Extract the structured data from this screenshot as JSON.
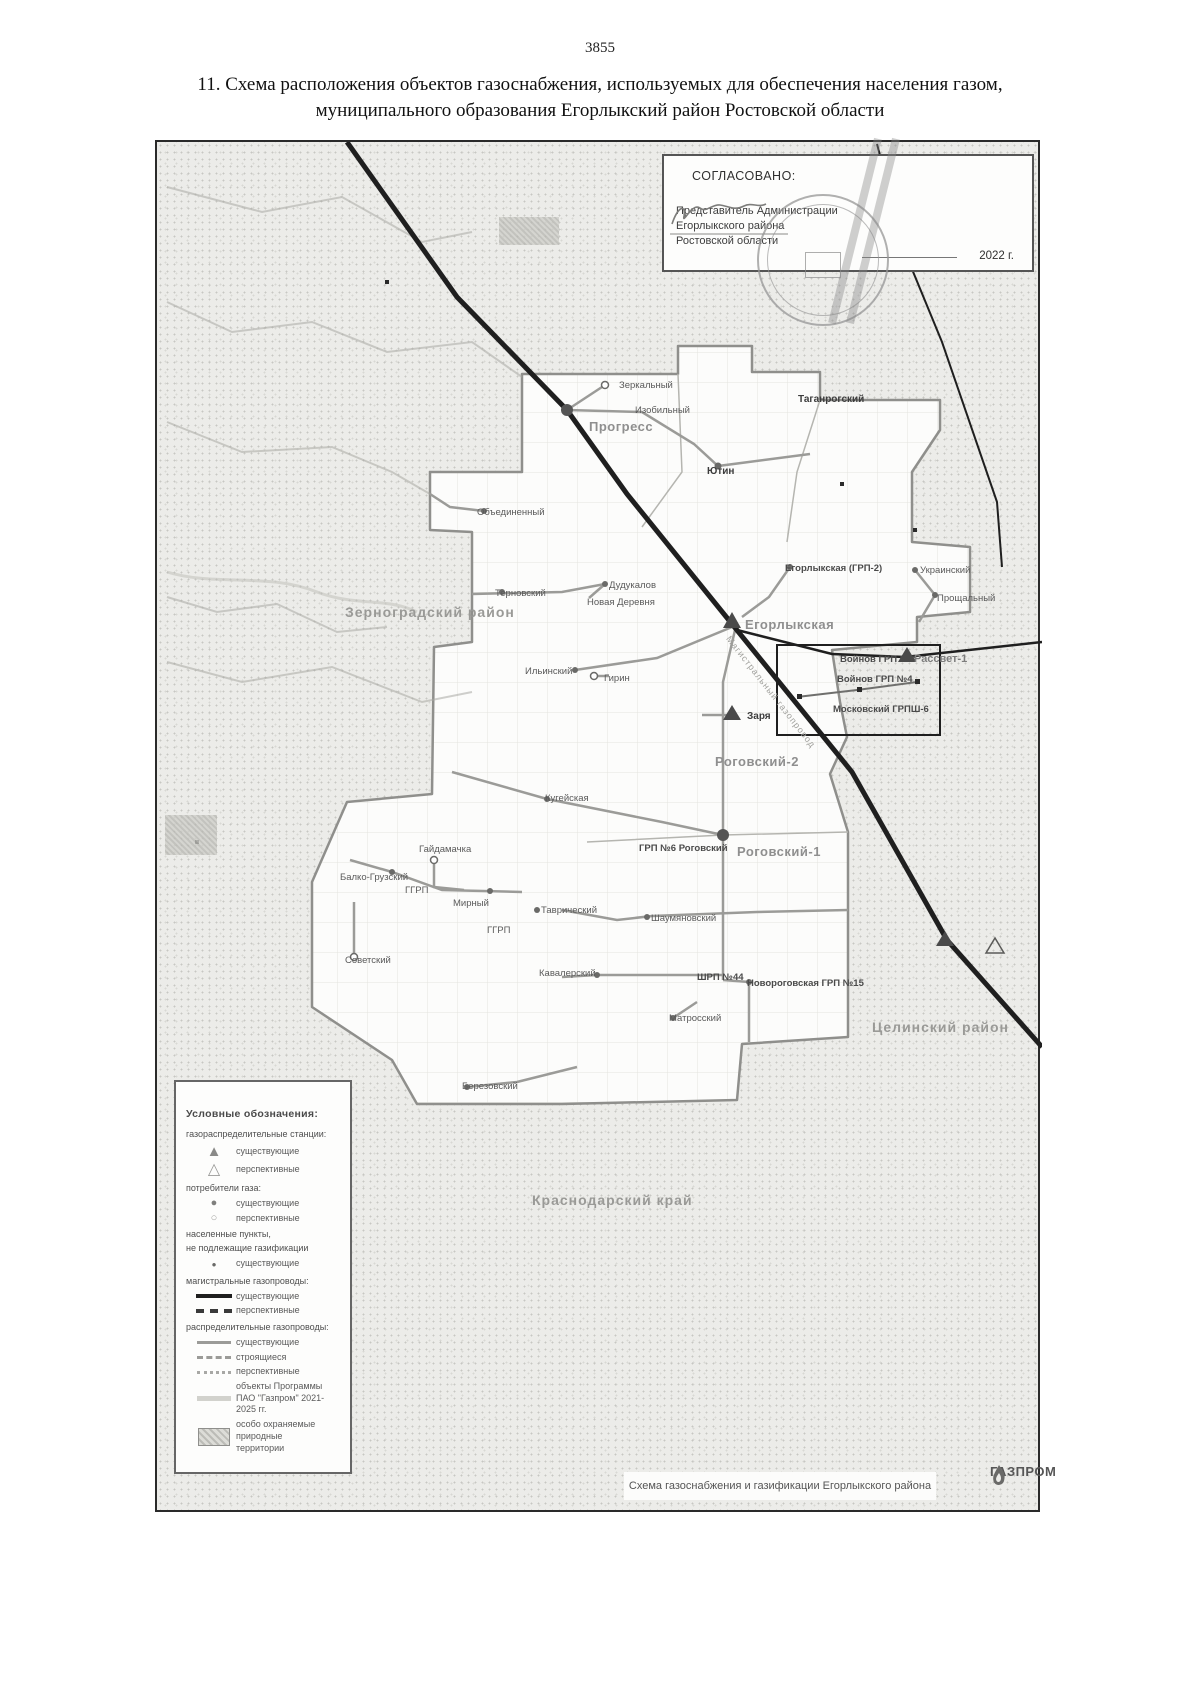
{
  "page": {
    "number": "3855",
    "title_line1": "11. Схема расположения объектов газоснабжения, используемых для обеспечения населения газом,",
    "title_line2": "муниципального образования Егорлыкский район Ростовской области"
  },
  "approval": {
    "heading": "СОГЛАСОВАНО:",
    "lines": [
      "Представитель Администрации",
      "Егорлыкского района",
      "Ростовской области"
    ],
    "year": "2022 г.",
    "stamp": "round-seal",
    "signature": "handwritten-signature"
  },
  "map": {
    "caption": "Схема газоснабжения и газификации Егорлыкского района",
    "brand": "ГАЗПРОМ",
    "pipeline_label": "Магистральный газопровод",
    "colors": {
      "main_pipeline": "#1f1f1f",
      "distribution": "#9b9b98",
      "boundary": "#8f8f8c"
    },
    "labels": [
      {
        "text": "Зеркальный",
        "x": 462,
        "y": 239
      },
      {
        "text": "Изобильный",
        "x": 478,
        "y": 264
      },
      {
        "text": "Прогресс",
        "x": 432,
        "y": 278,
        "cls": "town"
      },
      {
        "text": "Таганрогский",
        "x": 641,
        "y": 253,
        "cls": "dark"
      },
      {
        "text": "Ютин",
        "x": 550,
        "y": 325,
        "cls": "dark"
      },
      {
        "text": "Объединенный",
        "x": 320,
        "y": 366
      },
      {
        "text": "Терновский",
        "x": 338,
        "y": 447
      },
      {
        "text": "Дудукалов",
        "x": 452,
        "y": 439
      },
      {
        "text": "Новая Деревня",
        "x": 430,
        "y": 456
      },
      {
        "text": "Егорлыкская (ГРП-2)",
        "x": 628,
        "y": 422,
        "cls": "grp"
      },
      {
        "text": "Украинский",
        "x": 763,
        "y": 424
      },
      {
        "text": "Прощальный",
        "x": 780,
        "y": 452
      },
      {
        "text": "Зерноградский район",
        "x": 188,
        "y": 463,
        "cls": "region"
      },
      {
        "text": "Егорлыкская",
        "x": 588,
        "y": 476,
        "cls": "town"
      },
      {
        "text": "Войнов ГРП №3",
        "x": 683,
        "y": 513,
        "cls": "grp"
      },
      {
        "text": "Войнов ГРП №4",
        "x": 680,
        "y": 533,
        "cls": "grp"
      },
      {
        "text": "Рассвет-1",
        "x": 757,
        "y": 512,
        "cls": "town-sm"
      },
      {
        "text": "Московский ГРПШ-6",
        "x": 676,
        "y": 563,
        "cls": "grp"
      },
      {
        "text": "Ильинский",
        "x": 368,
        "y": 525
      },
      {
        "text": "Гирин",
        "x": 447,
        "y": 532
      },
      {
        "text": "Заря",
        "x": 590,
        "y": 570,
        "cls": "dark"
      },
      {
        "text": "Роговский-2",
        "x": 558,
        "y": 613,
        "cls": "town"
      },
      {
        "text": "Кугейская",
        "x": 388,
        "y": 652
      },
      {
        "text": "Гайдамачка",
        "x": 262,
        "y": 703
      },
      {
        "text": "Балко-Грузский",
        "x": 183,
        "y": 731
      },
      {
        "text": "ГГРП",
        "x": 248,
        "y": 744
      },
      {
        "text": "Мирный",
        "x": 296,
        "y": 757
      },
      {
        "text": "ГГРП",
        "x": 330,
        "y": 784
      },
      {
        "text": "Таврический",
        "x": 384,
        "y": 764
      },
      {
        "text": "Советский",
        "x": 188,
        "y": 814
      },
      {
        "text": "Шаумяновский",
        "x": 494,
        "y": 772
      },
      {
        "text": "Кавалерский",
        "x": 382,
        "y": 827
      },
      {
        "text": "ШРП №44",
        "x": 540,
        "y": 831,
        "cls": "grp"
      },
      {
        "text": "Новороговская ГРП №15",
        "x": 590,
        "y": 837,
        "cls": "grp"
      },
      {
        "text": "Матросский",
        "x": 512,
        "y": 872
      },
      {
        "text": "ГРП №6 Роговский",
        "x": 482,
        "y": 702,
        "cls": "grp"
      },
      {
        "text": "Роговский-1",
        "x": 580,
        "y": 703,
        "cls": "town"
      },
      {
        "text": "Целинский район",
        "x": 715,
        "y": 878,
        "cls": "region"
      },
      {
        "text": "Краснодарский край",
        "x": 375,
        "y": 1051,
        "cls": "region"
      },
      {
        "text": "Березовский",
        "x": 305,
        "y": 940
      }
    ]
  },
  "legend": {
    "title": "Условные обозначения:",
    "sections": [
      {
        "label": "газораспределительные станции:",
        "items": [
          {
            "swatch": "tri-f",
            "text": "существующие"
          },
          {
            "swatch": "tri-o",
            "text": "перспективные"
          }
        ]
      },
      {
        "label": "потребители газа:",
        "items": [
          {
            "swatch": "cir-f",
            "text": "существующие"
          },
          {
            "swatch": "cir-o",
            "text": "перспективные"
          }
        ]
      },
      {
        "label": "населенные пункты,\nне подлежащие газификации",
        "items": [
          {
            "swatch": "dot",
            "text": "существующие"
          }
        ]
      },
      {
        "label": "магистральные газопроводы:",
        "items": [
          {
            "swatch": "sw-mg-e",
            "text": "существующие"
          },
          {
            "swatch": "sw-mg-p",
            "text": "перспективные"
          }
        ]
      },
      {
        "label": "распределительные газопроводы:",
        "items": [
          {
            "swatch": "sw-rg-e",
            "text": "существующие"
          },
          {
            "swatch": "sw-rg-s",
            "text": "строящиеся"
          },
          {
            "swatch": "sw-rg-p",
            "text": "перспективные"
          },
          {
            "swatch": "sw-prog",
            "text": "объекты Программы\nПАО \"Газпром\" 2021-2025 гг."
          },
          {
            "swatch": "sw-oopt",
            "text": "особо охраняемые природные\nтерритории"
          }
        ]
      }
    ]
  }
}
